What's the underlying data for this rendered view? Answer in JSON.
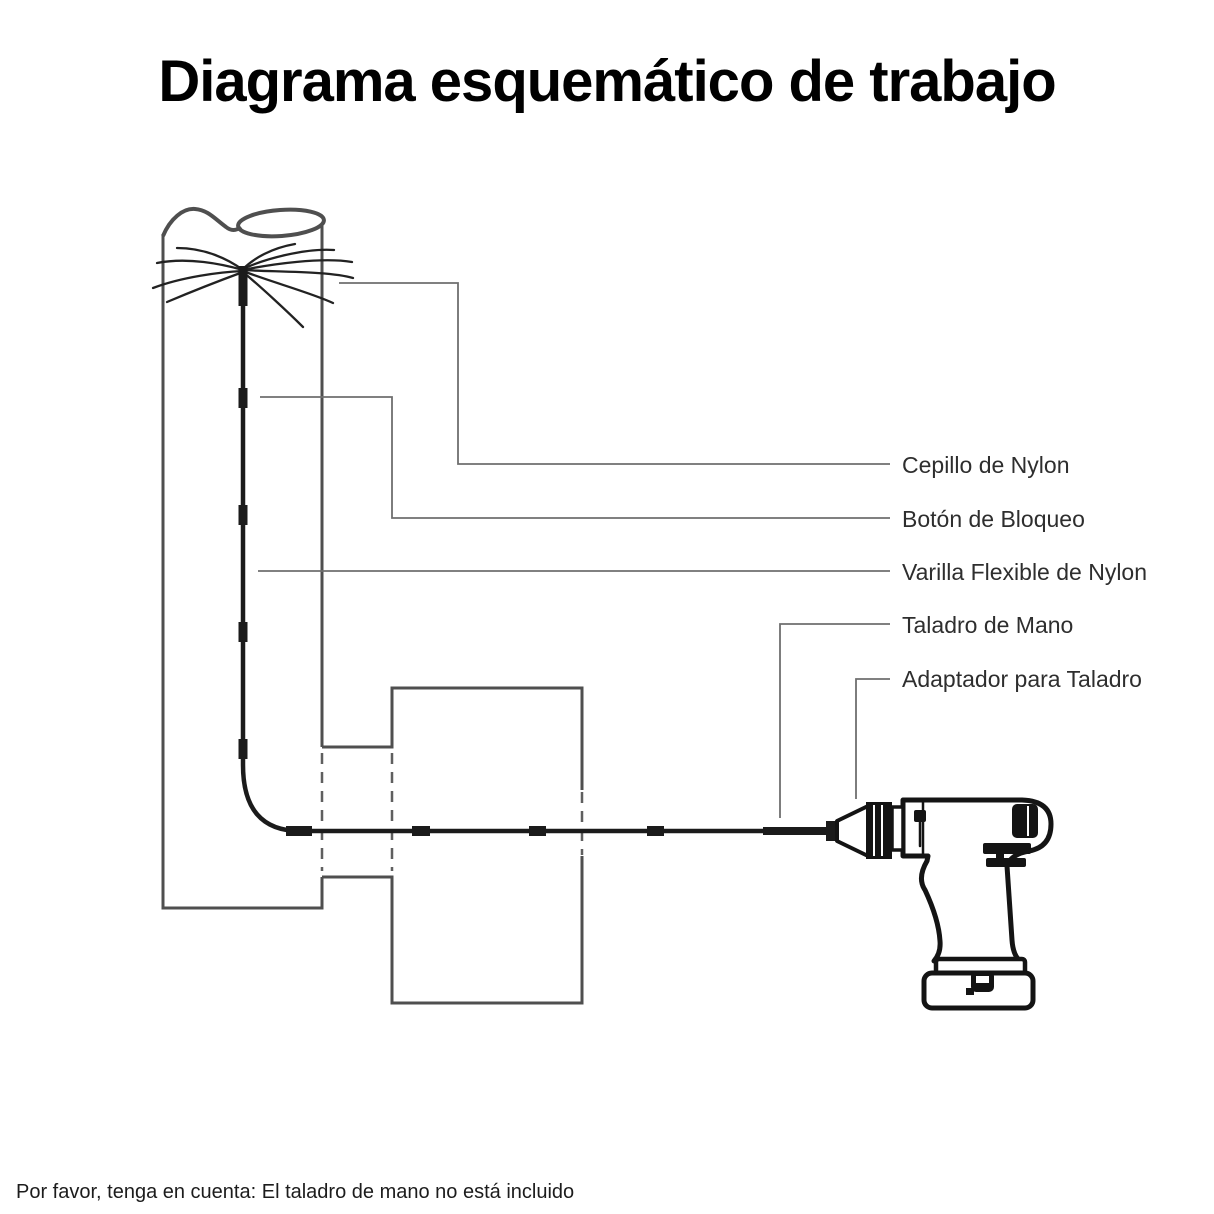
{
  "title": "Diagrama esquemático de trabajo",
  "footer_note": "Por favor, tenga en cuenta: El taladro de mano no está incluido",
  "labels": {
    "brush": "Cepillo de Nylon",
    "lock_button": "Botón de Bloqueo",
    "flexible_rod": "Varilla Flexible de Nylon",
    "hand_drill": "Taladro de Mano",
    "drill_adapter": "Adaptador para Taladro"
  },
  "colors": {
    "background": "#ffffff",
    "pipe_outline": "#4f4f4f",
    "hidden_edge": "#5f5f5f",
    "leader_line": "#6f6f6f",
    "rod_ink": "#1b1b1b",
    "drill_ink": "#141414",
    "label_text": "#2e2e2e",
    "title_text": "#000000"
  }
}
